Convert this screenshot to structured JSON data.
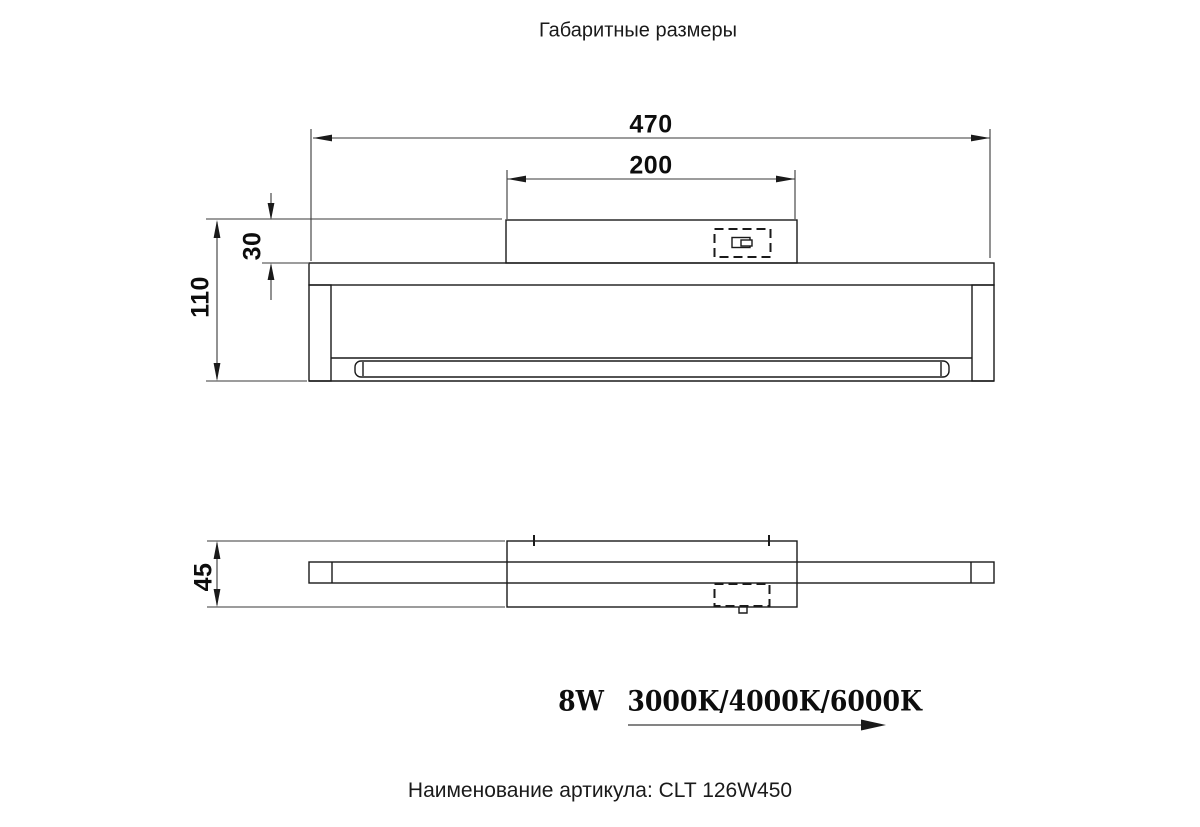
{
  "title": "Габаритные размеры",
  "front_view": {
    "dim_overall_width_mm": "470",
    "dim_plate_width_mm": "200",
    "dim_plate_height_mm": "30",
    "dim_overall_height_mm": "110"
  },
  "top_view": {
    "dim_depth_mm": "45"
  },
  "specs": {
    "wattage": "8W",
    "color_temperatures": "3000K/4000K/6000K"
  },
  "caption": {
    "label": "Наименование артикула:",
    "article": "CLT 126W450"
  },
  "colors": {
    "background": "#ffffff",
    "object_line": "#1a1a1a",
    "dimension_line": "#3a3a3a"
  }
}
